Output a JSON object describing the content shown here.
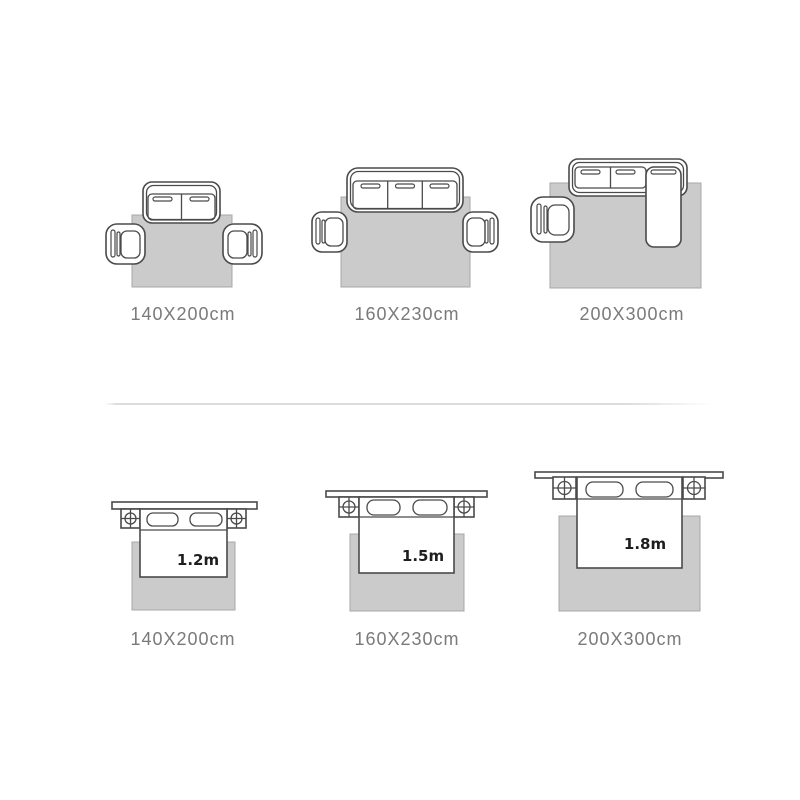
{
  "image": {
    "type": "rug-size-guide",
    "background": "#ffffff"
  },
  "colors": {
    "rug_fill": "#cbcbcb",
    "rug_border": "#a7a7a7",
    "furniture_outline": "#4a4a4a",
    "furniture_fill": "#ffffff",
    "caption_text": "#7a7a7a",
    "bed_width_text": "#1e1e1e",
    "divider": "#dcdcdc"
  },
  "icons": {
    "sofa_2seat": "two-seat sofa top view",
    "sofa_3seat": "three-seat sofa top view",
    "sofa_chaise": "sectional sofa with chaise top view",
    "armchair": "armchair top view",
    "bed": "bed with pillows top view",
    "nightstand": "nightstand with lamp crosshair symbol",
    "rug": "gray area rug"
  },
  "sofa_section": {
    "panels": [
      {
        "rug_size": "140X200cm"
      },
      {
        "rug_size": "160X230cm"
      },
      {
        "rug_size": "200X300cm"
      }
    ]
  },
  "bed_section": {
    "panels": [
      {
        "bed_width": "1.2m",
        "rug_size": "140X200cm"
      },
      {
        "bed_width": "1.5m",
        "rug_size": "160X230cm"
      },
      {
        "bed_width": "1.8m",
        "rug_size": "200X300cm"
      }
    ]
  }
}
